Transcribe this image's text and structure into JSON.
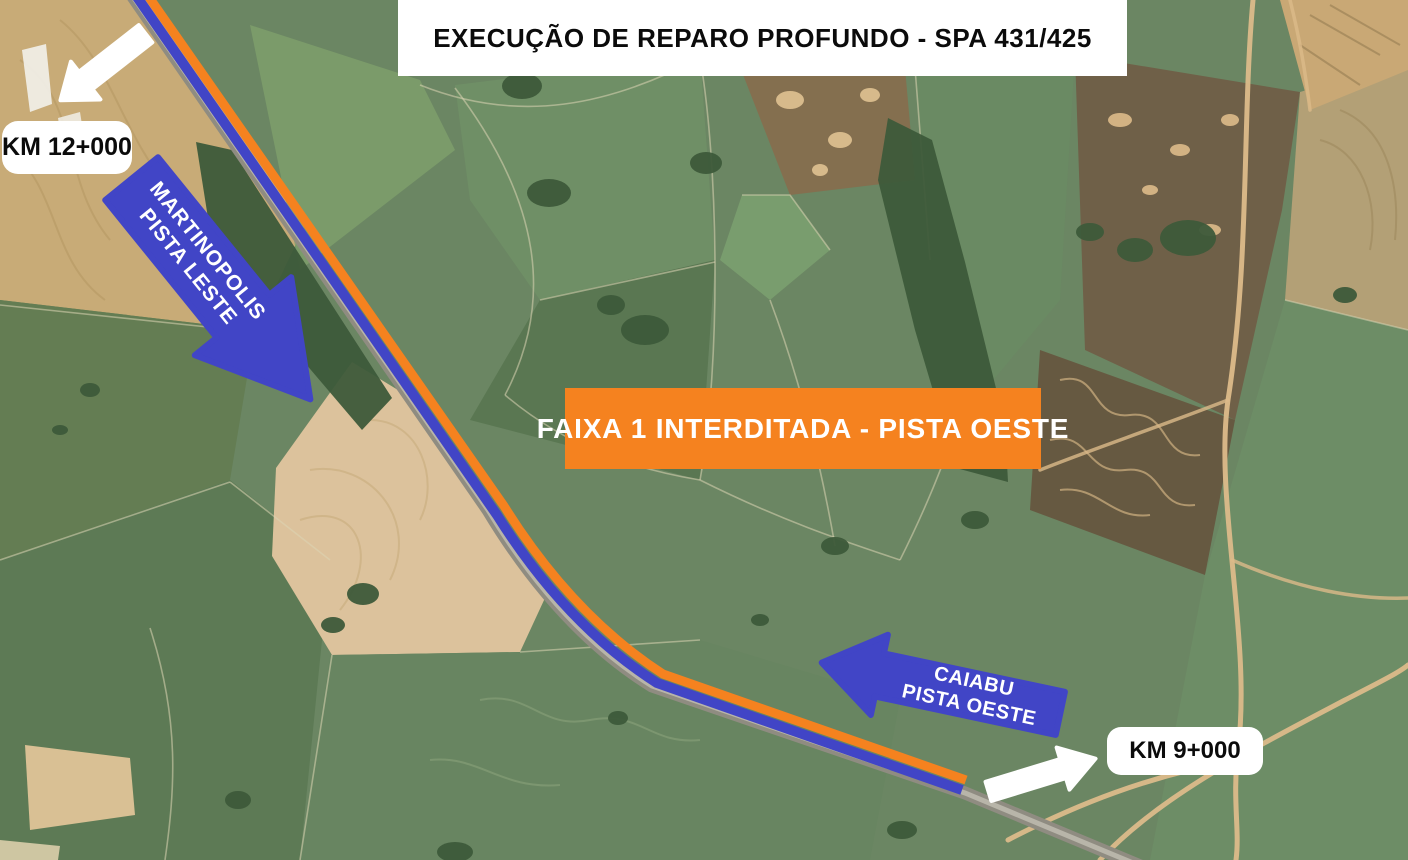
{
  "title": {
    "text": "EXECUÇÃO DE REPARO PROFUNDO - SPA 431/425"
  },
  "closure_banner": {
    "text": "FAIXA 1 INTERDITADA - PISTA OESTE"
  },
  "markers": {
    "km_start": {
      "label": "KM 12+000"
    },
    "km_end": {
      "label": "KM 9+000"
    }
  },
  "direction_arrows": {
    "martinopolis": {
      "line1": "MARTINOPOLIS",
      "line2": "PISTA LESTE"
    },
    "caiabu": {
      "line1": "CAIABU",
      "line2": "PISTA OESTE"
    }
  },
  "colors": {
    "closure_orange": "#F5821F",
    "direction_blue": "#4145C6",
    "marker_white": "#FFFFFF",
    "label_text": "#0B0B0B"
  }
}
